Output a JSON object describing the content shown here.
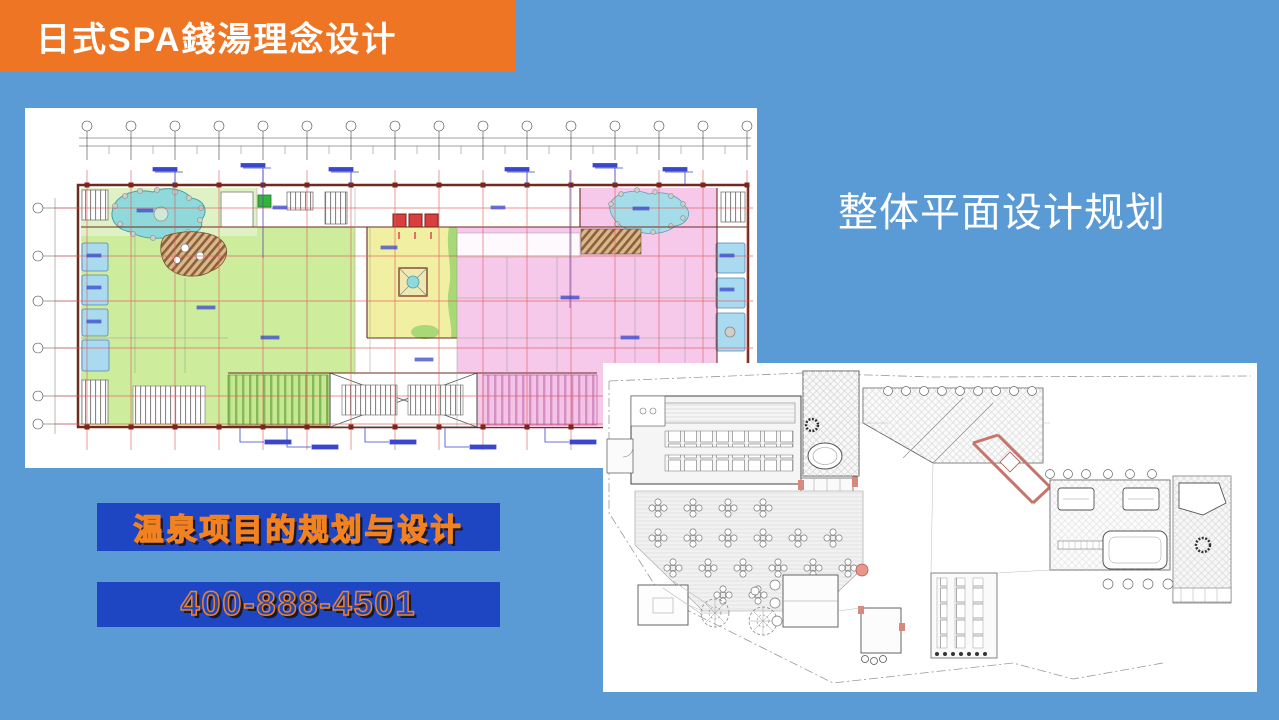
{
  "slide": {
    "header": {
      "title": "日式SPA錢湯理念设计",
      "bg_color": "#EE7524",
      "text_color": "#FFFFFF"
    },
    "section_title": "整体平面设计规划",
    "contact": {
      "promo_label": "温泉项目的规划与设计",
      "phone_label": "400-888-4501",
      "banner_bg_color": "#1E46C3",
      "text_color": "#F28220"
    },
    "background_color": "#5B9BD5",
    "figures": {
      "main_plan": "colored spa bathhouse ground floor plan with dimension grid",
      "secondary_plan": "monochrome restaurant and onsen site floor plan"
    },
    "palette": {
      "plan_green_room": "#CDEC9C",
      "plan_garden_green": "#DFF2C6",
      "plan_pink_room": "#F6C9EB",
      "plan_yellow_court": "#F1EFA2",
      "plan_pond_cyan": "#8FD9DA",
      "plan_pool_blue": "#A9DAEF",
      "plan_deck_brown": "#8E5F38",
      "plan_grid_red": "#E25858",
      "plan_wall_maroon": "#6E2A1E",
      "plan_annotation_blue": "#3A46CC",
      "plan2_accent_salmon": "#C4766B"
    }
  }
}
